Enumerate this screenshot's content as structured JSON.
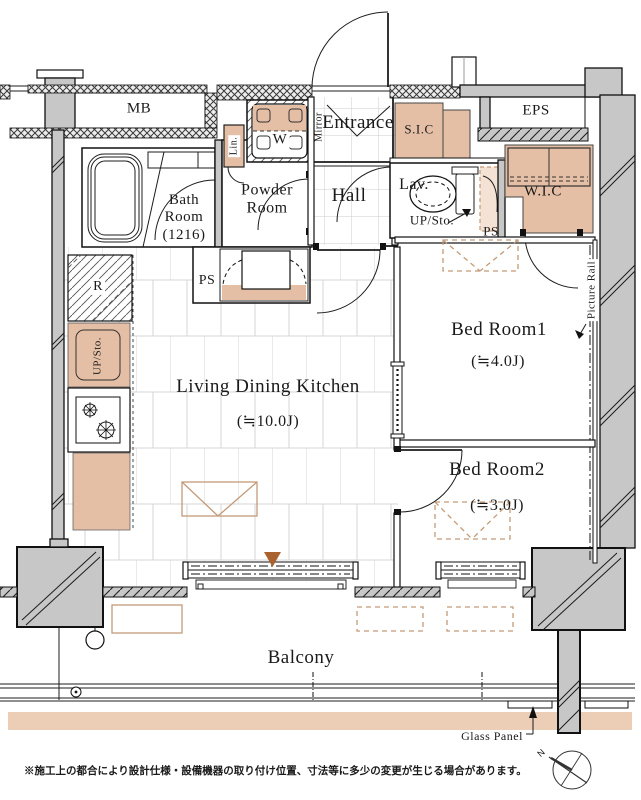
{
  "colors": {
    "wall_gray": "#c7c7c7",
    "fixture_tan": "#e4bfa6",
    "dashed_tan": "#c49a78",
    "balcony_strip": "#eccdb6",
    "accent_triangle": "#a9622e",
    "line": "#1c1c1c"
  },
  "labels": {
    "mb": "MB",
    "eps": "EPS",
    "entrance": "Entrance",
    "mirror": "Mirror",
    "sic": "S.I.C",
    "lin": "Lin.",
    "washer": "W",
    "bath_room": "Bath Room (1216)",
    "powder_room": "Powder Room",
    "hall": "Hall",
    "lav": "Lav.",
    "up_sto": "UP/Sto.",
    "ps_upper": "PS",
    "wic": "W.I.C",
    "picture_rail": "Picture Rail",
    "bedroom1_name": "Bed Room1",
    "bedroom1_size": "(≒4.0J)",
    "ps_kitchen": "PS",
    "fridge": "R",
    "up_sto_kitchen": "UP/Sto.",
    "ldk_name": "Living Dining Kitchen",
    "ldk_size": "(≒10.0J)",
    "bedroom2_name": "Bed Room2",
    "bedroom2_size": "(≒3.0J)",
    "balcony": "Balcony",
    "glass_panel": "Glass Panel",
    "compass_north": "N",
    "footnote": "※施工上の都合により設計仕様・設備機器の取り付け位置、寸法等に多少の変更が生じる場合があります。"
  }
}
